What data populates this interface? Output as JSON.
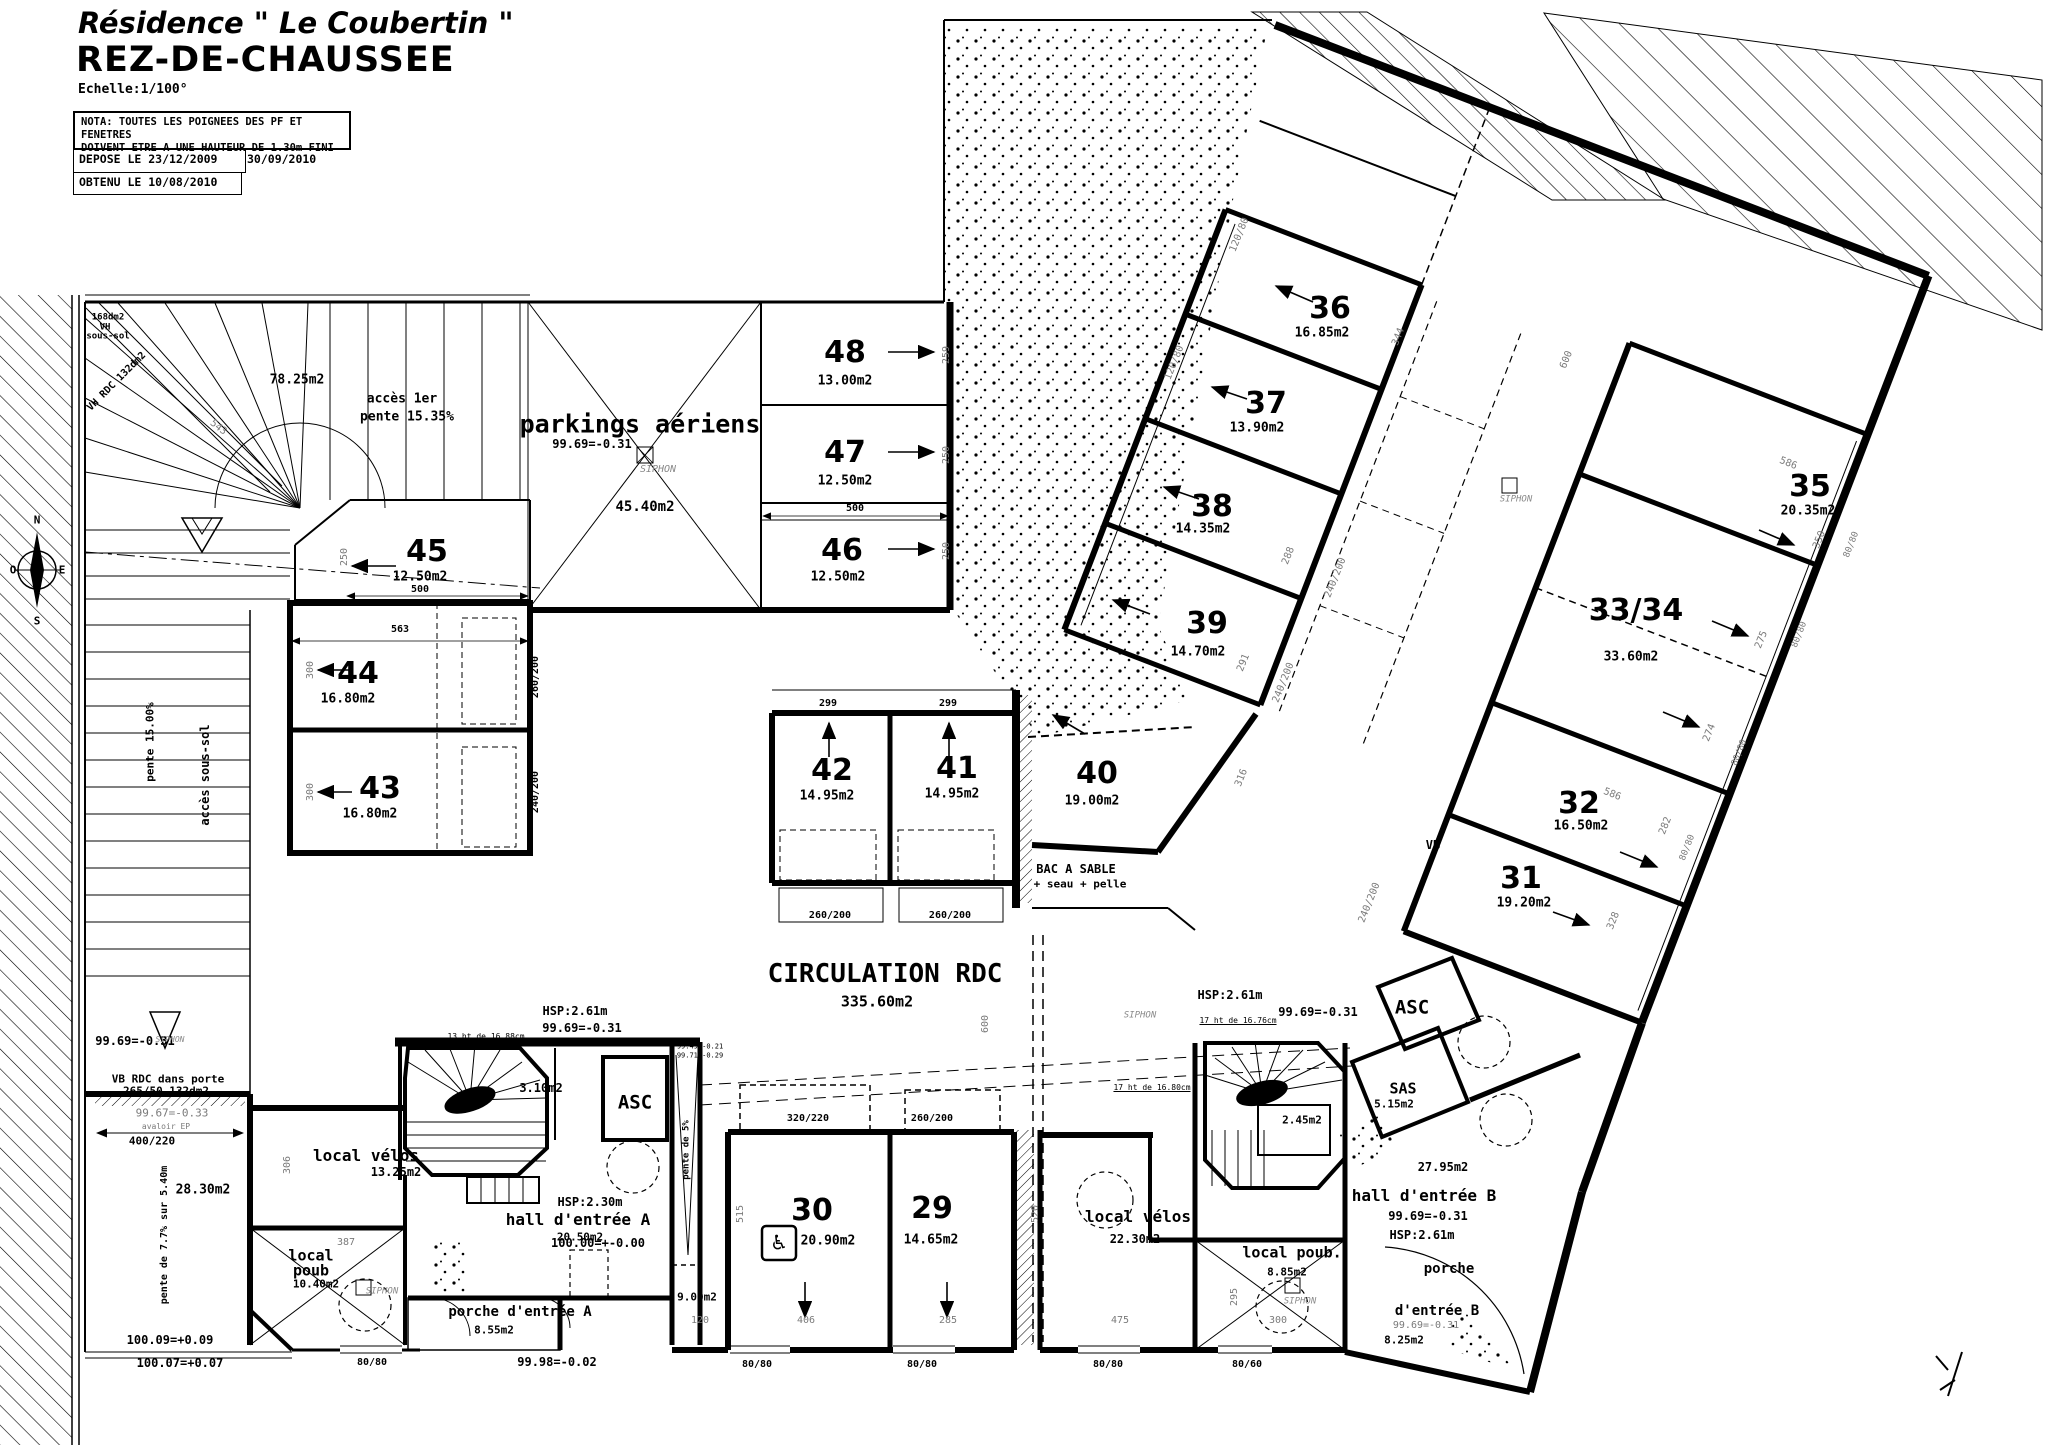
{
  "header": {
    "title": "Résidence \" Le Coubertin \"",
    "subtitle": "REZ-DE-CHAUSSEE",
    "scale": "Echelle:1/100°",
    "nota_line1": "NOTA: TOUTES LES POIGNEES DES PF ET FENETRES",
    "nota_line2": "DOIVENT ETRE A UNE HAUTEUR DE 1.30m FINI",
    "depose": "DEPOSE LE 23/12/2009",
    "date2": "30/09/2010",
    "obtenu": "OBTENU LE 10/08/2010"
  },
  "compass": {
    "north": "N",
    "south": "S",
    "east": "E",
    "west": "O"
  },
  "colors": {
    "ink": "#000000",
    "faint": "#7a7a7a"
  },
  "rooms": [
    {
      "n": "48",
      "a": "13.00m2",
      "x": 845,
      "y": 353,
      "ax": 845,
      "ay": 381
    },
    {
      "n": "47",
      "a": "12.50m2",
      "x": 845,
      "y": 453,
      "ax": 845,
      "ay": 481
    },
    {
      "n": "46",
      "a": "12.50m2",
      "x": 842,
      "y": 551,
      "ax": 838,
      "ay": 577
    },
    {
      "n": "45",
      "a": "12.50m2",
      "x": 427,
      "y": 552,
      "ax": 420,
      "ay": 577
    },
    {
      "n": "44",
      "a": "16.80m2",
      "x": 358,
      "y": 674,
      "ax": 348,
      "ay": 699
    },
    {
      "n": "43",
      "a": "16.80m2",
      "x": 380,
      "y": 789,
      "ax": 370,
      "ay": 814
    },
    {
      "n": "42",
      "a": "14.95m2",
      "x": 832,
      "y": 771,
      "ax": 827,
      "ay": 796
    },
    {
      "n": "41",
      "a": "14.95m2",
      "x": 957,
      "y": 769,
      "ax": 952,
      "ay": 794
    },
    {
      "n": "40",
      "a": "19.00m2",
      "x": 1097,
      "y": 774,
      "ax": 1092,
      "ay": 801
    },
    {
      "n": "39",
      "a": "14.70m2",
      "x": 1207,
      "y": 624,
      "ax": 1198,
      "ay": 652
    },
    {
      "n": "38",
      "a": "14.35m2",
      "x": 1212,
      "y": 507,
      "ax": 1203,
      "ay": 529
    },
    {
      "n": "37",
      "a": "13.90m2",
      "x": 1266,
      "y": 404,
      "ax": 1257,
      "ay": 428
    },
    {
      "n": "36",
      "a": "16.85m2",
      "x": 1330,
      "y": 309,
      "ax": 1322,
      "ay": 333
    },
    {
      "n": "35",
      "a": "20.35m2",
      "x": 1810,
      "y": 487,
      "ax": 1808,
      "ay": 511
    },
    {
      "n": "33/34",
      "a": "33.60m2",
      "x": 1636,
      "y": 611,
      "ax": 1631,
      "ay": 657
    },
    {
      "n": "32",
      "a": "16.50m2",
      "x": 1579,
      "y": 804,
      "ax": 1581,
      "ay": 826
    },
    {
      "n": "31",
      "a": "19.20m2",
      "x": 1521,
      "y": 879,
      "ax": 1524,
      "ay": 903
    },
    {
      "n": "30",
      "a": "20.90m2",
      "x": 812,
      "y": 1211,
      "ax": 828,
      "ay": 1241
    },
    {
      "n": "29",
      "a": "14.65m2",
      "x": 932,
      "y": 1209,
      "ax": 931,
      "ay": 1240
    }
  ],
  "annotations": [
    {
      "t": "parkings aériens",
      "x": 640,
      "y": 424,
      "s": 25,
      "c": "b",
      "nm": "label-parkings-aeriens"
    },
    {
      "t": "45.40m2",
      "x": 645,
      "y": 507,
      "s": 14,
      "c": "b"
    },
    {
      "t": "99.69=-0.31",
      "x": 592,
      "y": 444,
      "s": 12,
      "c": "L"
    },
    {
      "t": "CIRCULATION RDC",
      "x": 885,
      "y": 974,
      "s": 26,
      "c": "b",
      "nm": "label-circulation-rdc"
    },
    {
      "t": "335.60m2",
      "x": 877,
      "y": 1002,
      "s": 15,
      "c": "b"
    },
    {
      "t": "78.25m2",
      "x": 297,
      "y": 380,
      "s": 13,
      "c": "b"
    },
    {
      "t": "accès 1er",
      "x": 402,
      "y": 399,
      "s": 13,
      "c": "b"
    },
    {
      "t": "pente 15.35%",
      "x": 407,
      "y": 417,
      "s": 13,
      "c": "b"
    },
    {
      "t": "168dm2",
      "x": 108,
      "y": 318,
      "s": 9,
      "c": "b"
    },
    {
      "t": "VH",
      "x": 105,
      "y": 328,
      "s": 9,
      "c": "b"
    },
    {
      "t": "sous-sol",
      "x": 108,
      "y": 337,
      "s": 9,
      "c": "b"
    },
    {
      "t": "VH RDC 132dm2",
      "x": 117,
      "y": 382,
      "s": 10,
      "r": -45,
      "c": "b"
    },
    {
      "t": "accès sous-sol",
      "x": 205,
      "y": 775,
      "s": 12,
      "r": -90,
      "c": "b"
    },
    {
      "t": "pente 15.00%",
      "x": 150,
      "y": 742,
      "s": 11,
      "r": -90,
      "c": "b"
    },
    {
      "t": "BAC A SABLE",
      "x": 1076,
      "y": 869,
      "s": 12,
      "c": "b"
    },
    {
      "t": "+ seau + pelle",
      "x": 1080,
      "y": 884,
      "s": 11,
      "c": "b"
    },
    {
      "t": "28.30m2",
      "x": 203,
      "y": 1190,
      "s": 13,
      "c": "b"
    },
    {
      "t": "pente de 7.7% sur 5.40m",
      "x": 165,
      "y": 1235,
      "s": 10,
      "r": -90,
      "c": "b"
    },
    {
      "t": "VB RDC dans porte",
      "x": 168,
      "y": 1079,
      "s": 11,
      "c": "b"
    },
    {
      "t": "265/50 132dm2",
      "x": 166,
      "y": 1091,
      "s": 11,
      "c": "b"
    },
    {
      "t": "avaloir EP",
      "x": 166,
      "y": 1127,
      "s": 8,
      "c": "g"
    },
    {
      "t": "400/220",
      "x": 152,
      "y": 1141,
      "s": 11,
      "c": "b"
    },
    {
      "t": "99.69=-0.31",
      "x": 135,
      "y": 1041,
      "s": 12,
      "c": "L"
    },
    {
      "t": "99.67=-0.33",
      "x": 172,
      "y": 1113,
      "s": 11,
      "c": "g"
    },
    {
      "t": "100.09=+0.09",
      "x": 170,
      "y": 1340,
      "s": 12,
      "c": "L"
    },
    {
      "t": "100.07=+0.07",
      "x": 180,
      "y": 1363,
      "s": 12,
      "c": "L"
    },
    {
      "t": "local vélos",
      "x": 366,
      "y": 1156,
      "s": 16,
      "c": "b",
      "nm": "label-local-velos-a"
    },
    {
      "t": "13.25m2",
      "x": 396,
      "y": 1172,
      "s": 12,
      "c": "b"
    },
    {
      "t": "local",
      "x": 311,
      "y": 1256,
      "s": 15,
      "c": "b",
      "nm": "label-local-poub-a"
    },
    {
      "t": "poub",
      "x": 311,
      "y": 1271,
      "s": 15,
      "c": "b"
    },
    {
      "t": "10.40m2",
      "x": 316,
      "y": 1284,
      "s": 11,
      "c": "b"
    },
    {
      "t": "hall d'entrée A",
      "x": 578,
      "y": 1220,
      "s": 16,
      "c": "b",
      "nm": "label-hall-a"
    },
    {
      "t": "20.50m2",
      "x": 580,
      "y": 1237,
      "s": 11,
      "c": "b"
    },
    {
      "t": "HSP:2.30m",
      "x": 590,
      "y": 1202,
      "s": 12,
      "c": "b"
    },
    {
      "t": "100.00=+-0.00",
      "x": 598,
      "y": 1243,
      "s": 12,
      "c": "L"
    },
    {
      "t": "porche d'entrée A",
      "x": 520,
      "y": 1312,
      "s": 14,
      "c": "b",
      "nm": "label-porche-a"
    },
    {
      "t": "8.55m2",
      "x": 494,
      "y": 1330,
      "s": 11,
      "c": "b"
    },
    {
      "t": "9.00m2",
      "x": 697,
      "y": 1297,
      "s": 11,
      "c": "b"
    },
    {
      "t": "3.10m2",
      "x": 541,
      "y": 1088,
      "s": 12,
      "c": "b"
    },
    {
      "t": "ASC",
      "x": 635,
      "y": 1103,
      "s": 19,
      "c": "b",
      "nm": "label-asc-a"
    },
    {
      "t": "pente de 5%",
      "x": 687,
      "y": 1150,
      "s": 9,
      "r": -90,
      "c": "b"
    },
    {
      "t": "99.49=-0.21",
      "x": 700,
      "y": 1047,
      "s": 7,
      "c": "t"
    },
    {
      "t": "99.71=-0.29",
      "x": 700,
      "y": 1056,
      "s": 7,
      "c": "t"
    },
    {
      "t": "99.98=-0.02",
      "x": 557,
      "y": 1362,
      "s": 12,
      "c": "L"
    },
    {
      "t": "HSP:2.61m",
      "x": 575,
      "y": 1011,
      "s": 12,
      "c": "b"
    },
    {
      "t": "99.69=-0.31",
      "x": 582,
      "y": 1028,
      "s": 12,
      "c": "L"
    },
    {
      "t": "13 ht de 16.88cm",
      "x": 486,
      "y": 1037,
      "s": 8,
      "c": "tu"
    },
    {
      "t": "HSP:2.61m",
      "x": 1230,
      "y": 995,
      "s": 12,
      "c": "b"
    },
    {
      "t": "17 ht de 16.76cm",
      "x": 1238,
      "y": 1021,
      "s": 8,
      "c": "tu"
    },
    {
      "t": "17 ht de 16.80cm",
      "x": 1152,
      "y": 1088,
      "s": 8,
      "c": "tu"
    },
    {
      "t": "99.69=-0.31",
      "x": 1318,
      "y": 1012,
      "s": 12,
      "c": "L"
    },
    {
      "t": "ASC",
      "x": 1412,
      "y": 1008,
      "s": 19,
      "c": "b",
      "nm": "label-asc-b"
    },
    {
      "t": "SAS",
      "x": 1403,
      "y": 1089,
      "s": 15,
      "c": "b"
    },
    {
      "t": "5.15m2",
      "x": 1394,
      "y": 1104,
      "s": 11,
      "c": "b"
    },
    {
      "t": "2.45m2",
      "x": 1302,
      "y": 1120,
      "s": 11,
      "c": "b"
    },
    {
      "t": "local vélos",
      "x": 1138,
      "y": 1217,
      "s": 16,
      "c": "b",
      "nm": "label-local-velos-b"
    },
    {
      "t": "22.30m2",
      "x": 1135,
      "y": 1239,
      "s": 12,
      "c": "b"
    },
    {
      "t": "local poub.",
      "x": 1292,
      "y": 1253,
      "s": 15,
      "c": "b",
      "nm": "label-local-poub-b"
    },
    {
      "t": "8.85m2",
      "x": 1287,
      "y": 1272,
      "s": 11,
      "c": "b"
    },
    {
      "t": "27.95m2",
      "x": 1443,
      "y": 1167,
      "s": 12,
      "c": "b"
    },
    {
      "t": "hall d'entrée B",
      "x": 1424,
      "y": 1196,
      "s": 16,
      "c": "b",
      "nm": "label-hall-b"
    },
    {
      "t": "99.69=-0.31",
      "x": 1428,
      "y": 1216,
      "s": 12,
      "c": "L"
    },
    {
      "t": "HSP:2.61m",
      "x": 1422,
      "y": 1235,
      "s": 12,
      "c": "b"
    },
    {
      "t": "porche",
      "x": 1449,
      "y": 1269,
      "s": 14,
      "c": "b",
      "nm": "label-porche-b"
    },
    {
      "t": "d'entrée B",
      "x": 1437,
      "y": 1311,
      "s": 14,
      "c": "b"
    },
    {
      "t": "99.69=-0.31",
      "x": 1426,
      "y": 1326,
      "s": 10,
      "c": "g"
    },
    {
      "t": "8.25m2",
      "x": 1404,
      "y": 1340,
      "s": 11,
      "c": "b"
    },
    {
      "t": "VB",
      "x": 1433,
      "y": 845,
      "s": 12,
      "c": "b"
    },
    {
      "t": "♿",
      "x": 779,
      "y": 1243,
      "s": 23,
      "nm": "wheelchair-icon"
    },
    {
      "t": "SIPHON",
      "x": 658,
      "y": 470,
      "s": 10,
      "c": "i"
    },
    {
      "t": "SIPHON",
      "x": 1140,
      "y": 1016,
      "s": 9,
      "c": "i"
    },
    {
      "t": "SIPHON",
      "x": 1516,
      "y": 500,
      "s": 9,
      "c": "i"
    },
    {
      "t": "SIPHON",
      "x": 1300,
      "y": 1302,
      "s": 9,
      "c": "i"
    },
    {
      "t": "SIPHON",
      "x": 382,
      "y": 1292,
      "s": 9,
      "c": "i"
    },
    {
      "t": "SIPHON",
      "x": 170,
      "y": 1040,
      "s": 8,
      "c": "i"
    },
    {
      "t": "500",
      "x": 855,
      "y": 509,
      "s": 10,
      "c": "b"
    },
    {
      "t": "500",
      "x": 420,
      "y": 590,
      "s": 10,
      "c": "b"
    },
    {
      "t": "563",
      "x": 400,
      "y": 630,
      "s": 10,
      "c": "b"
    },
    {
      "t": "299",
      "x": 828,
      "y": 704,
      "s": 10,
      "c": "b"
    },
    {
      "t": "299",
      "x": 948,
      "y": 704,
      "s": 10,
      "c": "b"
    },
    {
      "t": "260/200",
      "x": 830,
      "y": 916,
      "s": 10,
      "c": "b"
    },
    {
      "t": "260/200",
      "x": 950,
      "y": 916,
      "s": 10,
      "c": "b"
    },
    {
      "t": "320/220",
      "x": 808,
      "y": 1119,
      "s": 10,
      "c": "b"
    },
    {
      "t": "260/200",
      "x": 932,
      "y": 1119,
      "s": 10,
      "c": "b"
    },
    {
      "t": "80/80",
      "x": 757,
      "y": 1365,
      "s": 10,
      "c": "b"
    },
    {
      "t": "80/80",
      "x": 922,
      "y": 1365,
      "s": 10,
      "c": "b"
    },
    {
      "t": "80/80",
      "x": 372,
      "y": 1363,
      "s": 10,
      "c": "b"
    },
    {
      "t": "80/80",
      "x": 1108,
      "y": 1365,
      "s": 10,
      "c": "b"
    },
    {
      "t": "80/60",
      "x": 1247,
      "y": 1365,
      "s": 10,
      "c": "b"
    },
    {
      "t": "260/200",
      "x": 536,
      "y": 677,
      "s": 10,
      "r": -90,
      "c": "b"
    },
    {
      "t": "240/200",
      "x": 536,
      "y": 792,
      "s": 10,
      "r": -90,
      "c": "b"
    },
    {
      "t": "259",
      "x": 947,
      "y": 355,
      "s": 10,
      "r": -90,
      "c": "g"
    },
    {
      "t": "250",
      "x": 947,
      "y": 455,
      "s": 10,
      "r": -90,
      "c": "g"
    },
    {
      "t": "250",
      "x": 947,
      "y": 551,
      "s": 10,
      "r": -90,
      "c": "g"
    },
    {
      "t": "250",
      "x": 345,
      "y": 557,
      "s": 10,
      "r": -90,
      "c": "g"
    },
    {
      "t": "300",
      "x": 311,
      "y": 670,
      "s": 10,
      "r": -90,
      "c": "g"
    },
    {
      "t": "300",
      "x": 311,
      "y": 792,
      "s": 10,
      "r": -90,
      "c": "g"
    },
    {
      "t": "306",
      "x": 288,
      "y": 1165,
      "s": 10,
      "r": -90,
      "c": "g"
    },
    {
      "t": "543",
      "x": 218,
      "y": 428,
      "s": 10,
      "r": 38,
      "c": "g"
    },
    {
      "t": "344",
      "x": 1399,
      "y": 337,
      "s": 10,
      "r": -68,
      "c": "g"
    },
    {
      "t": "288",
      "x": 1289,
      "y": 556,
      "s": 10,
      "r": -68,
      "c": "g"
    },
    {
      "t": "291",
      "x": 1244,
      "y": 663,
      "s": 10,
      "r": -68,
      "c": "g"
    },
    {
      "t": "316",
      "x": 1242,
      "y": 778,
      "s": 10,
      "r": -68,
      "c": "g"
    },
    {
      "t": "240/200",
      "x": 1336,
      "y": 578,
      "s": 10,
      "r": -68,
      "c": "g"
    },
    {
      "t": "240/200",
      "x": 1284,
      "y": 683,
      "s": 10,
      "r": -68,
      "c": "g"
    },
    {
      "t": "240/200",
      "x": 1370,
      "y": 903,
      "s": 10,
      "r": -68,
      "c": "g"
    },
    {
      "t": "120/80",
      "x": 1240,
      "y": 235,
      "s": 10,
      "r": -68,
      "c": "g"
    },
    {
      "t": "120/80",
      "x": 1175,
      "y": 363,
      "s": 10,
      "r": -68,
      "c": "g"
    },
    {
      "t": "600",
      "x": 1567,
      "y": 360,
      "s": 10,
      "r": -68,
      "c": "g"
    },
    {
      "t": "586",
      "x": 1788,
      "y": 464,
      "s": 10,
      "r": 22,
      "c": "g"
    },
    {
      "t": "586",
      "x": 1612,
      "y": 795,
      "s": 10,
      "r": 22,
      "c": "g"
    },
    {
      "t": "350",
      "x": 1820,
      "y": 540,
      "s": 10,
      "r": -68,
      "c": "g"
    },
    {
      "t": "275",
      "x": 1762,
      "y": 640,
      "s": 10,
      "r": -68,
      "c": "g"
    },
    {
      "t": "274",
      "x": 1710,
      "y": 733,
      "s": 10,
      "r": -68,
      "c": "g"
    },
    {
      "t": "282",
      "x": 1666,
      "y": 826,
      "s": 10,
      "r": -68,
      "c": "g"
    },
    {
      "t": "328",
      "x": 1614,
      "y": 921,
      "s": 10,
      "r": -68,
      "c": "g"
    },
    {
      "t": "80/80",
      "x": 1852,
      "y": 545,
      "s": 9,
      "r": -68,
      "c": "g"
    },
    {
      "t": "80/80",
      "x": 1800,
      "y": 635,
      "s": 9,
      "r": -68,
      "c": "g"
    },
    {
      "t": "80/80",
      "x": 1740,
      "y": 753,
      "s": 9,
      "r": -68,
      "c": "g"
    },
    {
      "t": "80/80",
      "x": 1688,
      "y": 848,
      "s": 9,
      "r": -68,
      "c": "g"
    },
    {
      "t": "475",
      "x": 1120,
      "y": 1321,
      "s": 10,
      "c": "g"
    },
    {
      "t": "295",
      "x": 1235,
      "y": 1297,
      "s": 10,
      "r": -90,
      "c": "g"
    },
    {
      "t": "300",
      "x": 1278,
      "y": 1321,
      "s": 10,
      "c": "g"
    },
    {
      "t": "387",
      "x": 346,
      "y": 1243,
      "s": 10,
      "c": "g"
    },
    {
      "t": "406",
      "x": 806,
      "y": 1321,
      "s": 10,
      "c": "g"
    },
    {
      "t": "285",
      "x": 948,
      "y": 1321,
      "s": 10,
      "c": "g"
    },
    {
      "t": "120",
      "x": 700,
      "y": 1321,
      "s": 10,
      "c": "g"
    },
    {
      "t": "515",
      "x": 741,
      "y": 1214,
      "s": 10,
      "r": -90,
      "c": "g"
    },
    {
      "t": "520",
      "x": 1036,
      "y": 1214,
      "s": 10,
      "r": -90,
      "c": "g"
    },
    {
      "t": "600",
      "x": 986,
      "y": 1024,
      "s": 10,
      "r": -90,
      "c": "g"
    }
  ]
}
